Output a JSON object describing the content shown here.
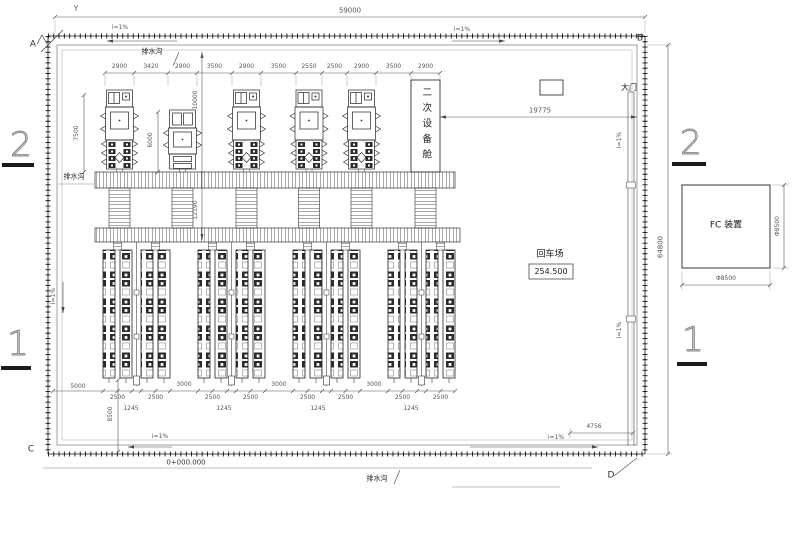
{
  "drawing": {
    "axis_symbol": "Y",
    "grid_marks": {
      "a": "A",
      "b": "B",
      "c": "C",
      "d": "D",
      "row_1": "1",
      "row_2": "2"
    },
    "labels": {
      "drain": "排水沟",
      "slope": "i=1%",
      "cabin": "二次设备舱",
      "gate": "大门",
      "turnaround": "回车场",
      "turnaround_elevation": "254.500",
      "fc_unit": "FC 装置",
      "chainage": "0+000.000"
    },
    "dims": {
      "site_width": "59000",
      "site_height": "64800",
      "gate_offset": "19775",
      "top_chain": [
        "2900",
        "3420",
        "2900",
        "3500",
        "2900",
        "3500",
        "2550",
        "2500",
        "2900",
        "3500",
        "2900"
      ],
      "transformer1_height": "7500",
      "transformer2_height": "6000",
      "trench_span_upper": "10000",
      "trench_span_lower": "12190",
      "edge_to_racks": "5000",
      "rack_group_gap": "3000",
      "rack_pair_width": "2500",
      "rack_half_width": "1245",
      "racks_to_fence": "8500",
      "corner_offset": "4756",
      "fc_size": "Φ8500"
    }
  }
}
